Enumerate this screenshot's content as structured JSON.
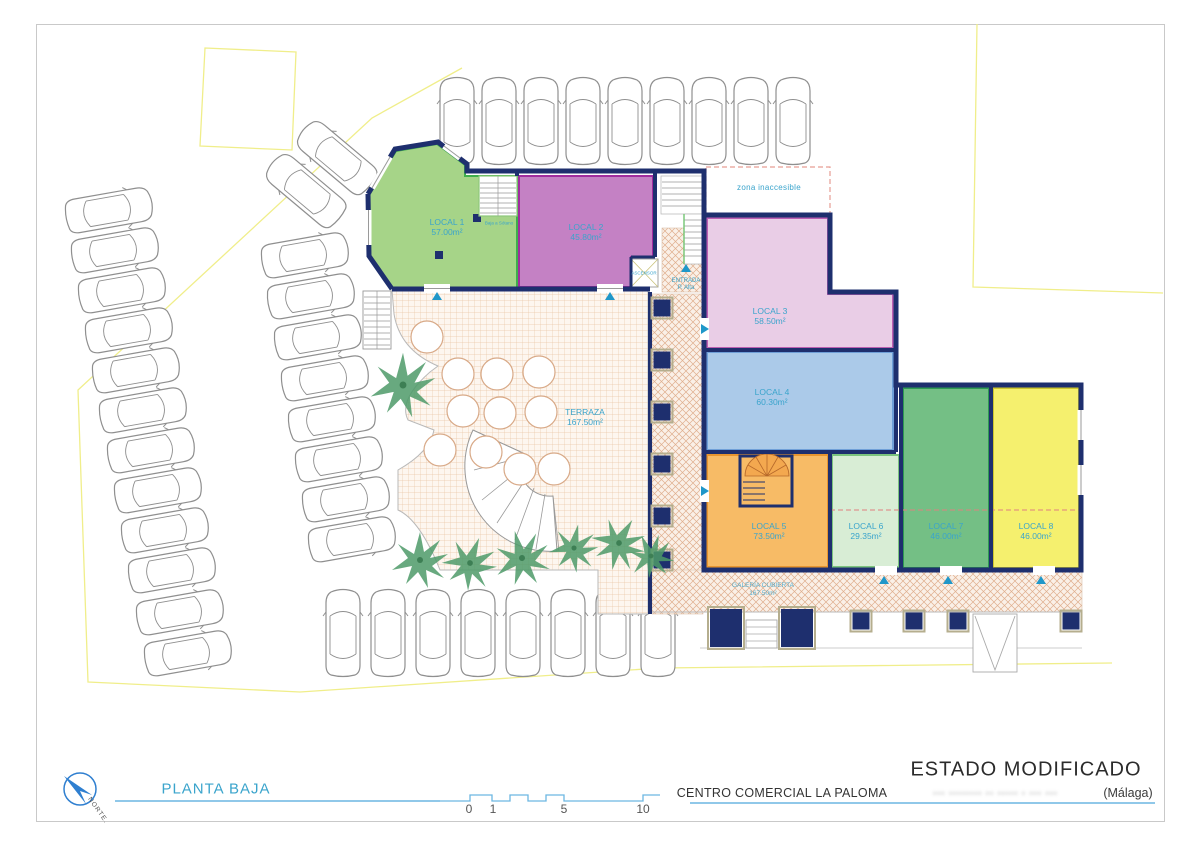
{
  "plan": {
    "locales": [
      {
        "name": "LOCAL 1",
        "area": "57.00m²"
      },
      {
        "name": "LOCAL 2",
        "area": "45.80m²"
      },
      {
        "name": "LOCAL 3",
        "area": "58.50m²"
      },
      {
        "name": "LOCAL 4",
        "area": "60.30m²"
      },
      {
        "name": "LOCAL 5",
        "area": "73.50m²"
      },
      {
        "name": "LOCAL 6",
        "area": "29.35m²"
      },
      {
        "name": "LOCAL 7",
        "area": "46.00m²"
      },
      {
        "name": "LOCAL 8",
        "area": "46.00m²"
      }
    ],
    "terraza": {
      "name": "TERRAZA",
      "area": "167.50m²"
    },
    "galeria": {
      "name": "GALERÍA CUBIERTA",
      "area": "167.50m²"
    },
    "zona_inaccesible": "zona inaccesible",
    "ascensor": "ASCENSOR",
    "entrada": {
      "line1": "ENTRADA",
      "line2": "P. Alta"
    },
    "stairs_note": "Baja a Sótano"
  },
  "title_block": {
    "floor_label": "PLANTA BAJA",
    "status": "ESTADO MODIFICADO",
    "project_name": "CENTRO COMERCIAL LA PALOMA",
    "address_obscured": "··· ········ ·· ····· · ··· ···",
    "address_city": "(Málaga)",
    "north_label": "NORTE."
  },
  "scale_bar": {
    "ticks": [
      "0",
      "1",
      "5",
      "10"
    ]
  },
  "colors": {
    "wall_navy": "#1e2f6e",
    "label_cyan": "#3aa4cc",
    "local1_fill": "#a6d488",
    "local1_edge": "#3fae4c",
    "local2_fill": "#c481c4",
    "local2_edge": "#a02c9e",
    "local3_fill": "#e9cde6",
    "local3_edge": "#bb5fb2",
    "local4_fill": "#abcae9",
    "local4_edge": "#6f9fd8",
    "local5_fill": "#f7bb66",
    "local5_edge": "#e8952f",
    "local6_fill": "#d8edd5",
    "local6_edge": "#7cc47e",
    "local7_fill": "#74bf85",
    "local7_edge": "#2f9a52",
    "local8_fill": "#f5f06e",
    "local8_edge": "#cdc62e",
    "boundary_yellow": "#f0ee8a",
    "paving_tan": "#dcab8a",
    "marker_blue": "#1f97c9",
    "zona_dash_red": "#e69d94"
  }
}
